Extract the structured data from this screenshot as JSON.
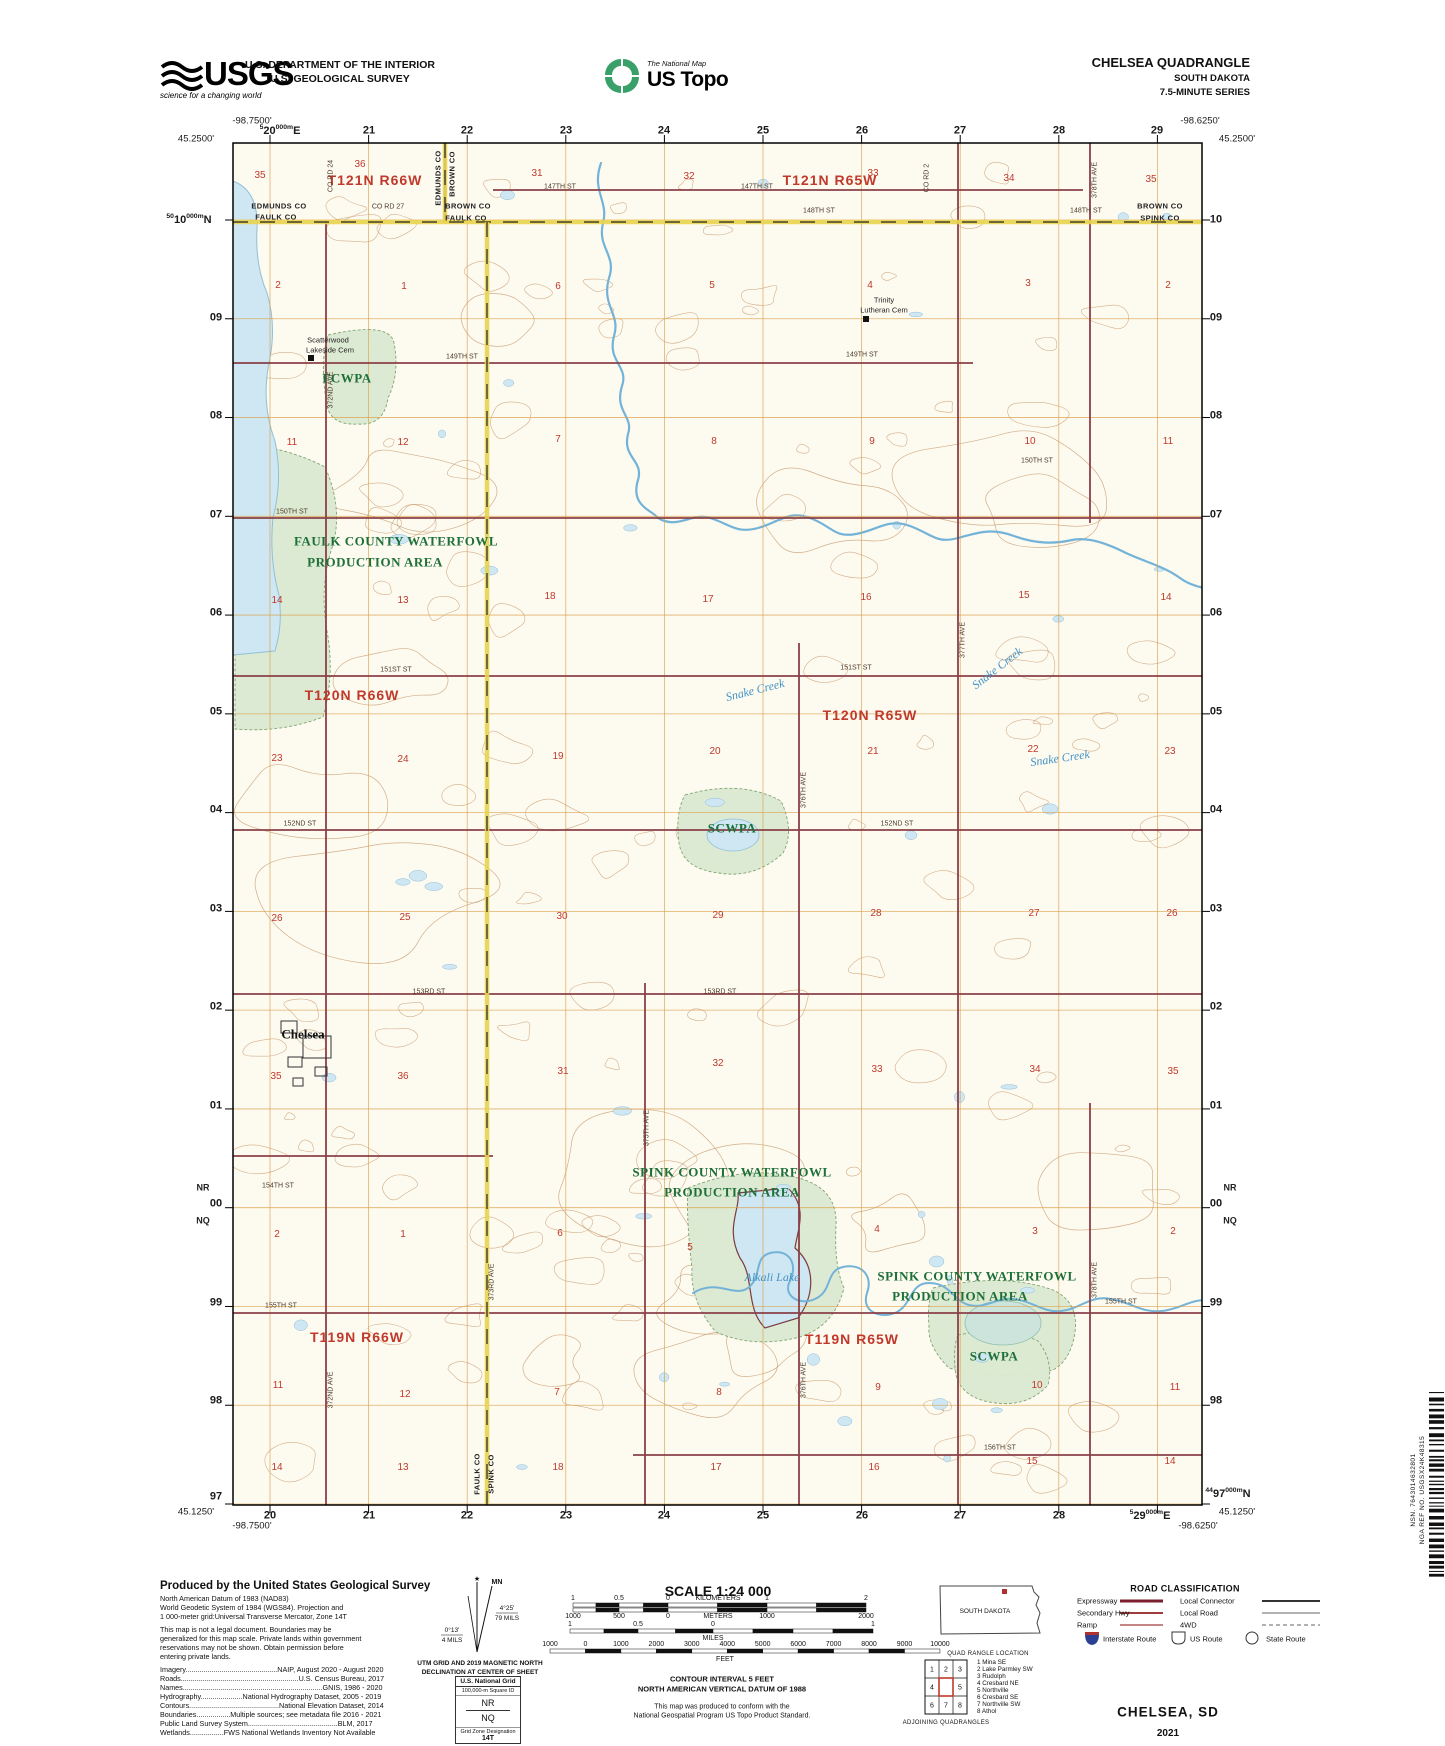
{
  "header": {
    "usgs_word": "USGS",
    "usgs_tagline": "science for a changing world",
    "dept_line1": "U.S. DEPARTMENT OF THE INTERIOR",
    "dept_line2": "U.S. GEOLOGICAL SURVEY",
    "ustopo_small": "The National Map",
    "ustopo_big": "US Topo",
    "quad_line1": "CHELSEA QUADRANGLE",
    "quad_line2": "SOUTH DAKOTA",
    "quad_line3": "7.5-MINUTE SERIES"
  },
  "colors": {
    "township_red": "#c0392b",
    "area_green": "#1e7038",
    "water_blue": "#4393c6",
    "road_maroon": "#8a4048",
    "grid_orange": "#dba04a",
    "county_yellow": "#e9d44f",
    "contour_brown": "#c79a6c"
  },
  "map": {
    "corners": [
      {
        "t": "-98.7500'",
        "x": 252,
        "y": 121
      },
      {
        "t": "45.2500'",
        "x": 196,
        "y": 139
      },
      {
        "t": "-98.6250'",
        "x": 1200,
        "y": 121
      },
      {
        "t": "45.2500'",
        "x": 1237,
        "y": 139
      },
      {
        "t": "45.1250'",
        "x": 196,
        "y": 1512
      },
      {
        "t": "-98.7500'",
        "x": 252,
        "y": 1526
      },
      {
        "t": "-98.6250'",
        "x": 1198,
        "y": 1526
      },
      {
        "t": "45.1250'",
        "x": 1237,
        "y": 1512
      }
    ],
    "eastings_top": [
      {
        "pre": "5",
        "t": "20",
        "post": "000m",
        "post2": "E",
        "x": 280,
        "y": 131
      },
      {
        "t": "21",
        "x": 369,
        "y": 131
      },
      {
        "t": "22",
        "x": 467,
        "y": 131
      },
      {
        "t": "23",
        "x": 566,
        "y": 131
      },
      {
        "t": "24",
        "x": 664,
        "y": 131
      },
      {
        "t": "25",
        "x": 763,
        "y": 131
      },
      {
        "t": "26",
        "x": 862,
        "y": 131
      },
      {
        "t": "27",
        "x": 960,
        "y": 131
      },
      {
        "t": "28",
        "x": 1059,
        "y": 131
      },
      {
        "t": "29",
        "x": 1157,
        "y": 131
      }
    ],
    "eastings_bottom": [
      {
        "t": "20",
        "x": 270,
        "y": 1516
      },
      {
        "t": "21",
        "x": 369,
        "y": 1516
      },
      {
        "t": "22",
        "x": 467,
        "y": 1516
      },
      {
        "t": "23",
        "x": 566,
        "y": 1516
      },
      {
        "t": "24",
        "x": 664,
        "y": 1516
      },
      {
        "t": "25",
        "x": 763,
        "y": 1516
      },
      {
        "t": "26",
        "x": 862,
        "y": 1516
      },
      {
        "t": "27",
        "x": 960,
        "y": 1516
      },
      {
        "t": "28",
        "x": 1059,
        "y": 1516
      },
      {
        "pre": "5",
        "t": "29",
        "post": "000m",
        "post2": "E",
        "x": 1150,
        "y": 1516
      }
    ],
    "northings_left": [
      {
        "pre": "50",
        "t": "10",
        "post": "000m",
        "post2": "N",
        "x": 189,
        "y": 220
      },
      {
        "t": "09",
        "x": 216,
        "y": 318
      },
      {
        "t": "08",
        "x": 216,
        "y": 416
      },
      {
        "t": "07",
        "x": 216,
        "y": 515
      },
      {
        "t": "06",
        "x": 216,
        "y": 613
      },
      {
        "t": "05",
        "x": 216,
        "y": 712
      },
      {
        "t": "04",
        "x": 216,
        "y": 810
      },
      {
        "t": "03",
        "x": 216,
        "y": 909
      },
      {
        "t": "02",
        "x": 216,
        "y": 1007
      },
      {
        "t": "01",
        "x": 216,
        "y": 1106
      },
      {
        "t": "00",
        "x": 216,
        "y": 1204
      },
      {
        "t": "99",
        "x": 216,
        "y": 1303
      },
      {
        "t": "98",
        "x": 216,
        "y": 1401
      },
      {
        "t": "97",
        "x": 216,
        "y": 1497
      }
    ],
    "northings_right": [
      {
        "t": "10",
        "x": 1216,
        "y": 220
      },
      {
        "t": "09",
        "x": 1216,
        "y": 318
      },
      {
        "t": "08",
        "x": 1216,
        "y": 416
      },
      {
        "t": "07",
        "x": 1216,
        "y": 515
      },
      {
        "t": "06",
        "x": 1216,
        "y": 613
      },
      {
        "t": "05",
        "x": 1216,
        "y": 712
      },
      {
        "t": "04",
        "x": 1216,
        "y": 810
      },
      {
        "t": "03",
        "x": 1216,
        "y": 909
      },
      {
        "t": "02",
        "x": 1216,
        "y": 1007
      },
      {
        "t": "01",
        "x": 1216,
        "y": 1106
      },
      {
        "t": "00",
        "x": 1216,
        "y": 1204
      },
      {
        "t": "99",
        "x": 1216,
        "y": 1303
      },
      {
        "t": "98",
        "x": 1216,
        "y": 1401
      },
      {
        "pre": "44",
        "t": "97",
        "post": "000m",
        "post2": "N",
        "x": 1228,
        "y": 1494
      }
    ],
    "edge_ids": [
      {
        "t": "NR",
        "x": 203,
        "y": 1188
      },
      {
        "t": "NQ",
        "x": 203,
        "y": 1221
      },
      {
        "t": "NR",
        "x": 1230,
        "y": 1188
      },
      {
        "t": "NQ",
        "x": 1230,
        "y": 1221
      }
    ],
    "township_labels": [
      {
        "t": "T121N R66W",
        "x": 375,
        "y": 180
      },
      {
        "t": "T121N R65W",
        "x": 830,
        "y": 180
      },
      {
        "t": "T120N R66W",
        "x": 352,
        "y": 695
      },
      {
        "t": "T120N R65W",
        "x": 870,
        "y": 715
      },
      {
        "t": "T119N R66W",
        "x": 357,
        "y": 1337
      },
      {
        "t": "T119N R65W",
        "x": 852,
        "y": 1339
      }
    ],
    "section_numbers": [
      {
        "t": "35",
        "x": 260,
        "y": 176
      },
      {
        "t": "36",
        "x": 360,
        "y": 165
      },
      {
        "t": "31",
        "x": 537,
        "y": 174
      },
      {
        "t": "32",
        "x": 689,
        "y": 177
      },
      {
        "t": "33",
        "x": 873,
        "y": 174
      },
      {
        "t": "34",
        "x": 1009,
        "y": 179
      },
      {
        "t": "35",
        "x": 1151,
        "y": 180
      },
      {
        "t": "2",
        "x": 278,
        "y": 286
      },
      {
        "t": "1",
        "x": 404,
        "y": 287
      },
      {
        "t": "6",
        "x": 558,
        "y": 287
      },
      {
        "t": "5",
        "x": 712,
        "y": 286
      },
      {
        "t": "4",
        "x": 870,
        "y": 286
      },
      {
        "t": "3",
        "x": 1028,
        "y": 284
      },
      {
        "t": "2",
        "x": 1168,
        "y": 286
      },
      {
        "t": "11",
        "x": 292,
        "y": 443
      },
      {
        "t": "12",
        "x": 403,
        "y": 443
      },
      {
        "t": "7",
        "x": 558,
        "y": 440
      },
      {
        "t": "8",
        "x": 714,
        "y": 442
      },
      {
        "t": "9",
        "x": 872,
        "y": 442
      },
      {
        "t": "10",
        "x": 1030,
        "y": 442
      },
      {
        "t": "11",
        "x": 1168,
        "y": 442
      },
      {
        "t": "14",
        "x": 277,
        "y": 601
      },
      {
        "t": "13",
        "x": 403,
        "y": 601
      },
      {
        "t": "18",
        "x": 550,
        "y": 597
      },
      {
        "t": "17",
        "x": 708,
        "y": 600
      },
      {
        "t": "16",
        "x": 866,
        "y": 598
      },
      {
        "t": "15",
        "x": 1024,
        "y": 596
      },
      {
        "t": "14",
        "x": 1166,
        "y": 598
      },
      {
        "t": "23",
        "x": 277,
        "y": 759
      },
      {
        "t": "24",
        "x": 403,
        "y": 760
      },
      {
        "t": "19",
        "x": 558,
        "y": 757
      },
      {
        "t": "20",
        "x": 715,
        "y": 752
      },
      {
        "t": "21",
        "x": 873,
        "y": 752
      },
      {
        "t": "22",
        "x": 1033,
        "y": 750
      },
      {
        "t": "23",
        "x": 1170,
        "y": 752
      },
      {
        "t": "26",
        "x": 277,
        "y": 919
      },
      {
        "t": "25",
        "x": 405,
        "y": 918
      },
      {
        "t": "30",
        "x": 562,
        "y": 917
      },
      {
        "t": "29",
        "x": 718,
        "y": 916
      },
      {
        "t": "28",
        "x": 876,
        "y": 914
      },
      {
        "t": "27",
        "x": 1034,
        "y": 914
      },
      {
        "t": "26",
        "x": 1172,
        "y": 914
      },
      {
        "t": "35",
        "x": 276,
        "y": 1077
      },
      {
        "t": "36",
        "x": 403,
        "y": 1077
      },
      {
        "t": "31",
        "x": 563,
        "y": 1072
      },
      {
        "t": "32",
        "x": 718,
        "y": 1064
      },
      {
        "t": "33",
        "x": 877,
        "y": 1070
      },
      {
        "t": "34",
        "x": 1035,
        "y": 1070
      },
      {
        "t": "35",
        "x": 1173,
        "y": 1072
      },
      {
        "t": "2",
        "x": 277,
        "y": 1235
      },
      {
        "t": "1",
        "x": 403,
        "y": 1235
      },
      {
        "t": "6",
        "x": 560,
        "y": 1234
      },
      {
        "t": "5",
        "x": 690,
        "y": 1248
      },
      {
        "t": "4",
        "x": 877,
        "y": 1230
      },
      {
        "t": "3",
        "x": 1035,
        "y": 1232
      },
      {
        "t": "2",
        "x": 1173,
        "y": 1232
      },
      {
        "t": "11",
        "x": 278,
        "y": 1386
      },
      {
        "t": "12",
        "x": 405,
        "y": 1395
      },
      {
        "t": "7",
        "x": 557,
        "y": 1393
      },
      {
        "t": "8",
        "x": 719,
        "y": 1393
      },
      {
        "t": "9",
        "x": 878,
        "y": 1388
      },
      {
        "t": "10",
        "x": 1037,
        "y": 1386
      },
      {
        "t": "11",
        "x": 1175,
        "y": 1388
      },
      {
        "t": "14",
        "x": 277,
        "y": 1468
      },
      {
        "t": "13",
        "x": 403,
        "y": 1468
      },
      {
        "t": "18",
        "x": 558,
        "y": 1468
      },
      {
        "t": "17",
        "x": 716,
        "y": 1468
      },
      {
        "t": "16",
        "x": 874,
        "y": 1468
      },
      {
        "t": "15",
        "x": 1032,
        "y": 1462
      },
      {
        "t": "14",
        "x": 1170,
        "y": 1462
      }
    ],
    "area_labels": [
      {
        "t": "FCWPA",
        "x": 347,
        "y": 378
      },
      {
        "t": "FAULK COUNTY WATERFOWL",
        "x": 396,
        "y": 541
      },
      {
        "t": "PRODUCTION AREA",
        "x": 375,
        "y": 562
      },
      {
        "t": "SCWPA",
        "x": 732,
        "y": 828
      },
      {
        "t": "SPINK COUNTY WATERFOWL",
        "x": 732,
        "y": 1172
      },
      {
        "t": "PRODUCTION AREA",
        "x": 732,
        "y": 1192
      },
      {
        "t": "SPINK COUNTY WATERFOWL",
        "x": 977,
        "y": 1276
      },
      {
        "t": "PRODUCTION AREA",
        "x": 960,
        "y": 1296
      },
      {
        "t": "SCWPA",
        "x": 994,
        "y": 1356
      }
    ],
    "water_labels": [
      {
        "t": "Snake Creek",
        "x": 755,
        "y": 690,
        "r": -14
      },
      {
        "t": "Snake Creek",
        "x": 997,
        "y": 668,
        "r": -38
      },
      {
        "t": "Snake Creek",
        "x": 1060,
        "y": 758,
        "r": -8
      },
      {
        "t": "Alkali Lake",
        "x": 772,
        "y": 1277
      }
    ],
    "place_labels": [
      {
        "t": "Chelsea",
        "x": 303,
        "y": 1034
      }
    ],
    "cem_labels": [
      {
        "t": "Scatterwood",
        "x": 328,
        "y": 340
      },
      {
        "t": "Lakeside Cem",
        "x": 330,
        "y": 350
      },
      {
        "t": "Trinity",
        "x": 884,
        "y": 300
      },
      {
        "t": "Lutheran Cem",
        "x": 884,
        "y": 310
      }
    ],
    "county_labels": [
      {
        "t": "EDMUNDS CO",
        "x": 279,
        "y": 206
      },
      {
        "t": "FAULK CO",
        "x": 276,
        "y": 217
      },
      {
        "t": "EDMUNDS CO",
        "x": 438,
        "y": 178,
        "r": -90
      },
      {
        "t": "BROWN CO",
        "x": 452,
        "y": 174,
        "r": -90
      },
      {
        "t": "BROWN CO",
        "x": 468,
        "y": 206
      },
      {
        "t": "FAULK CO",
        "x": 466,
        "y": 218
      },
      {
        "t": "BROWN CO",
        "x": 1160,
        "y": 206
      },
      {
        "t": "SPINK CO",
        "x": 1160,
        "y": 218
      },
      {
        "t": "FAULK CO",
        "x": 477,
        "y": 1474,
        "r": -90
      },
      {
        "t": "SPINK CO",
        "x": 491,
        "y": 1474,
        "r": -90
      }
    ],
    "road_labels": [
      {
        "t": "CO RD 24",
        "x": 331,
        "y": 176,
        "r": -90
      },
      {
        "t": "CO RD 27",
        "x": 388,
        "y": 207
      },
      {
        "t": "147TH ST",
        "x": 560,
        "y": 187
      },
      {
        "t": "147TH ST",
        "x": 757,
        "y": 187
      },
      {
        "t": "148TH ST",
        "x": 819,
        "y": 211
      },
      {
        "t": "148TH ST",
        "x": 1086,
        "y": 211
      },
      {
        "t": "CO RD 2",
        "x": 927,
        "y": 178,
        "r": -90
      },
      {
        "t": "149TH ST",
        "x": 462,
        "y": 357
      },
      {
        "t": "149TH ST",
        "x": 862,
        "y": 355
      },
      {
        "t": "150TH ST",
        "x": 292,
        "y": 512
      },
      {
        "t": "150TH ST",
        "x": 1037,
        "y": 461
      },
      {
        "t": "151ST ST",
        "x": 396,
        "y": 670
      },
      {
        "t": "151ST ST",
        "x": 856,
        "y": 668
      },
      {
        "t": "152ND ST",
        "x": 300,
        "y": 824
      },
      {
        "t": "152ND ST",
        "x": 897,
        "y": 824
      },
      {
        "t": "153RD ST",
        "x": 429,
        "y": 992
      },
      {
        "t": "153RD ST",
        "x": 720,
        "y": 992
      },
      {
        "t": "154TH ST",
        "x": 278,
        "y": 1186
      },
      {
        "t": "155TH ST",
        "x": 281,
        "y": 1306
      },
      {
        "t": "155TH ST",
        "x": 1121,
        "y": 1302
      },
      {
        "t": "156TH ST",
        "x": 1000,
        "y": 1448
      },
      {
        "t": "372ND AVE",
        "x": 331,
        "y": 390,
        "r": -90
      },
      {
        "t": "372ND AVE",
        "x": 331,
        "y": 1390,
        "r": -90
      },
      {
        "t": "373RD AVE",
        "x": 492,
        "y": 1282,
        "r": -90
      },
      {
        "t": "375TH AVE",
        "x": 647,
        "y": 1128,
        "r": -90
      },
      {
        "t": "376TH AVE",
        "x": 804,
        "y": 790,
        "r": -90
      },
      {
        "t": "376TH AVE",
        "x": 804,
        "y": 1380,
        "r": -90
      },
      {
        "t": "377TH AVE",
        "x": 963,
        "y": 640,
        "r": -90
      },
      {
        "t": "378TH AVE",
        "x": 1095,
        "y": 180,
        "r": -90
      },
      {
        "t": "378TH AVE",
        "x": 1095,
        "y": 1280,
        "r": -90
      }
    ]
  },
  "footer": {
    "produced": {
      "title": "Produced by the United States Geological Survey",
      "datum_lines": [
        "North American Datum of 1983 (NAD83)",
        "World Geodetic System of 1984 (WGS84).  Projection and",
        "1 000-meter grid:Universal Transverse Mercator, Zone 14T"
      ],
      "legal_lines": [
        "This map is not a legal document. Boundaries may be",
        "generalized for this map scale. Private lands within government",
        "reservations may not be shown. Obtain permission before",
        "entering private lands."
      ],
      "credit_lines": [
        "Imagery..............................................NAIP, August 2020 - August 2020",
        "Roads...........................................................U.S. Census Bureau, 2017",
        "Names......................................................................GNIS, 1986 - 2020",
        "Hydrography.....................National Hydrography Dataset, 2005 - 2019",
        "Contours.............................................National Elevation Dataset, 2014",
        "Boundaries.................Multiple sources; see metadata file 2016 - 2021",
        "Public Land Survey System.............................................BLM, 2017",
        "Wetlands.................FWS National Wetlands Inventory Not Available"
      ]
    },
    "declination": {
      "mn": "MN",
      "mn_value": "4°25'",
      "mn_mils": "79 MILS",
      "gn_value": "0°13'",
      "gn_mils": "4 MILS",
      "caption1": "UTM GRID AND 2019 MAGNETIC NORTH",
      "caption2": "DECLINATION AT CENTER OF SHEET"
    },
    "natgrid": {
      "title": "U.S. National Grid",
      "sub1": "100,000-m Square ID",
      "id1": "NR",
      "id2": "NQ",
      "sub2": "Grid Zone Designation",
      "zone": "14T"
    },
    "scale": {
      "title": "SCALE 1:24 000",
      "km_unit": "KILOMETERS",
      "km_labels": [
        "1",
        "0.5",
        "0",
        "1",
        "2"
      ],
      "m_unit": "METERS",
      "m_labels": [
        "1000",
        "500",
        "0",
        "1000",
        "2000"
      ],
      "mi_unit": "MILES",
      "mi_labels": [
        "1",
        "0.5",
        "0",
        "1"
      ],
      "ft_unit": "FEET",
      "ft_labels": [
        "1000",
        "0",
        "1000",
        "2000",
        "3000",
        "4000",
        "5000",
        "6000",
        "7000",
        "8000",
        "9000",
        "10000"
      ],
      "contour1": "CONTOUR INTERVAL 5 FEET",
      "contour2": "NORTH AMERICAN VERTICAL DATUM OF 1988",
      "note1": "This map was produced to conform with the",
      "note2": "National Geospatial Program US Topo Product Standard."
    },
    "quadloc": {
      "state": "SOUTH DAKOTA",
      "caption": "QUAD RANGLE LOCATION"
    },
    "adjoining": {
      "caption": "ADJOINING QUADRANGLES",
      "cells": [
        "1",
        "2",
        "3",
        "4",
        "5",
        "6",
        "7",
        "8"
      ],
      "names": [
        "1 Mina SE",
        "2 Lake Parmley SW",
        "3 Rudolph",
        "4 Cresbard NE",
        "5 Northville",
        "6 Cresbard SE",
        "7 Northville SW",
        "8 Athol"
      ]
    },
    "roadclass": {
      "title": "ROAD CLASSIFICATION",
      "left": [
        "Expressway",
        "Secondary Hwy",
        "Ramp"
      ],
      "right": [
        "Local Connector",
        "Local Road",
        "4WD"
      ],
      "shields": [
        "Interstate Route",
        "US Route",
        "State Route"
      ]
    },
    "titleblock": {
      "name": "CHELSEA,  SD",
      "year": "2021"
    },
    "edge": {
      "nsn": "NSN. 7643014632801",
      "nga": "NGA REF NO. USGSX24K48315"
    }
  }
}
